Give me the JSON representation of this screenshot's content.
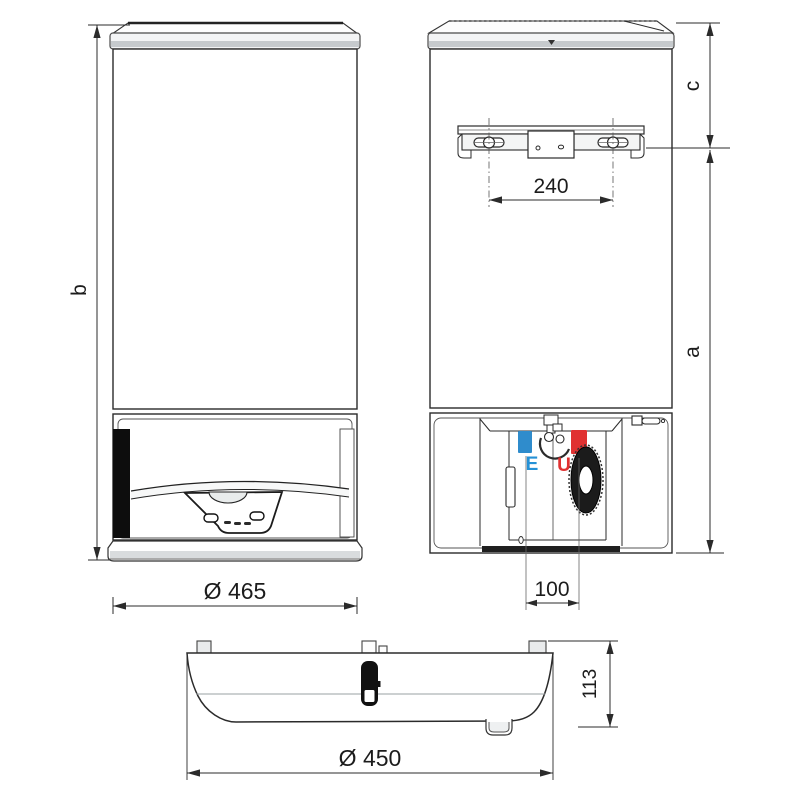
{
  "drawing": {
    "front": {
      "height_label": "b",
      "diameter": "Ø 465"
    },
    "rear": {
      "bracket_spacing": "240",
      "top_to_bracket_label": "c",
      "bracket_to_base_label": "a",
      "pipe_spacing": "100",
      "cold_inlet_label": "E",
      "hot_outlet_label": "U"
    },
    "bottom": {
      "depth": "113",
      "diameter": "Ø 450"
    },
    "colors": {
      "cold_inlet_blue": "#2f8ccc",
      "hot_outlet_red": "#e03131",
      "line_dark": "#2b2b2b",
      "panel_gray": "#c6cacd"
    }
  }
}
